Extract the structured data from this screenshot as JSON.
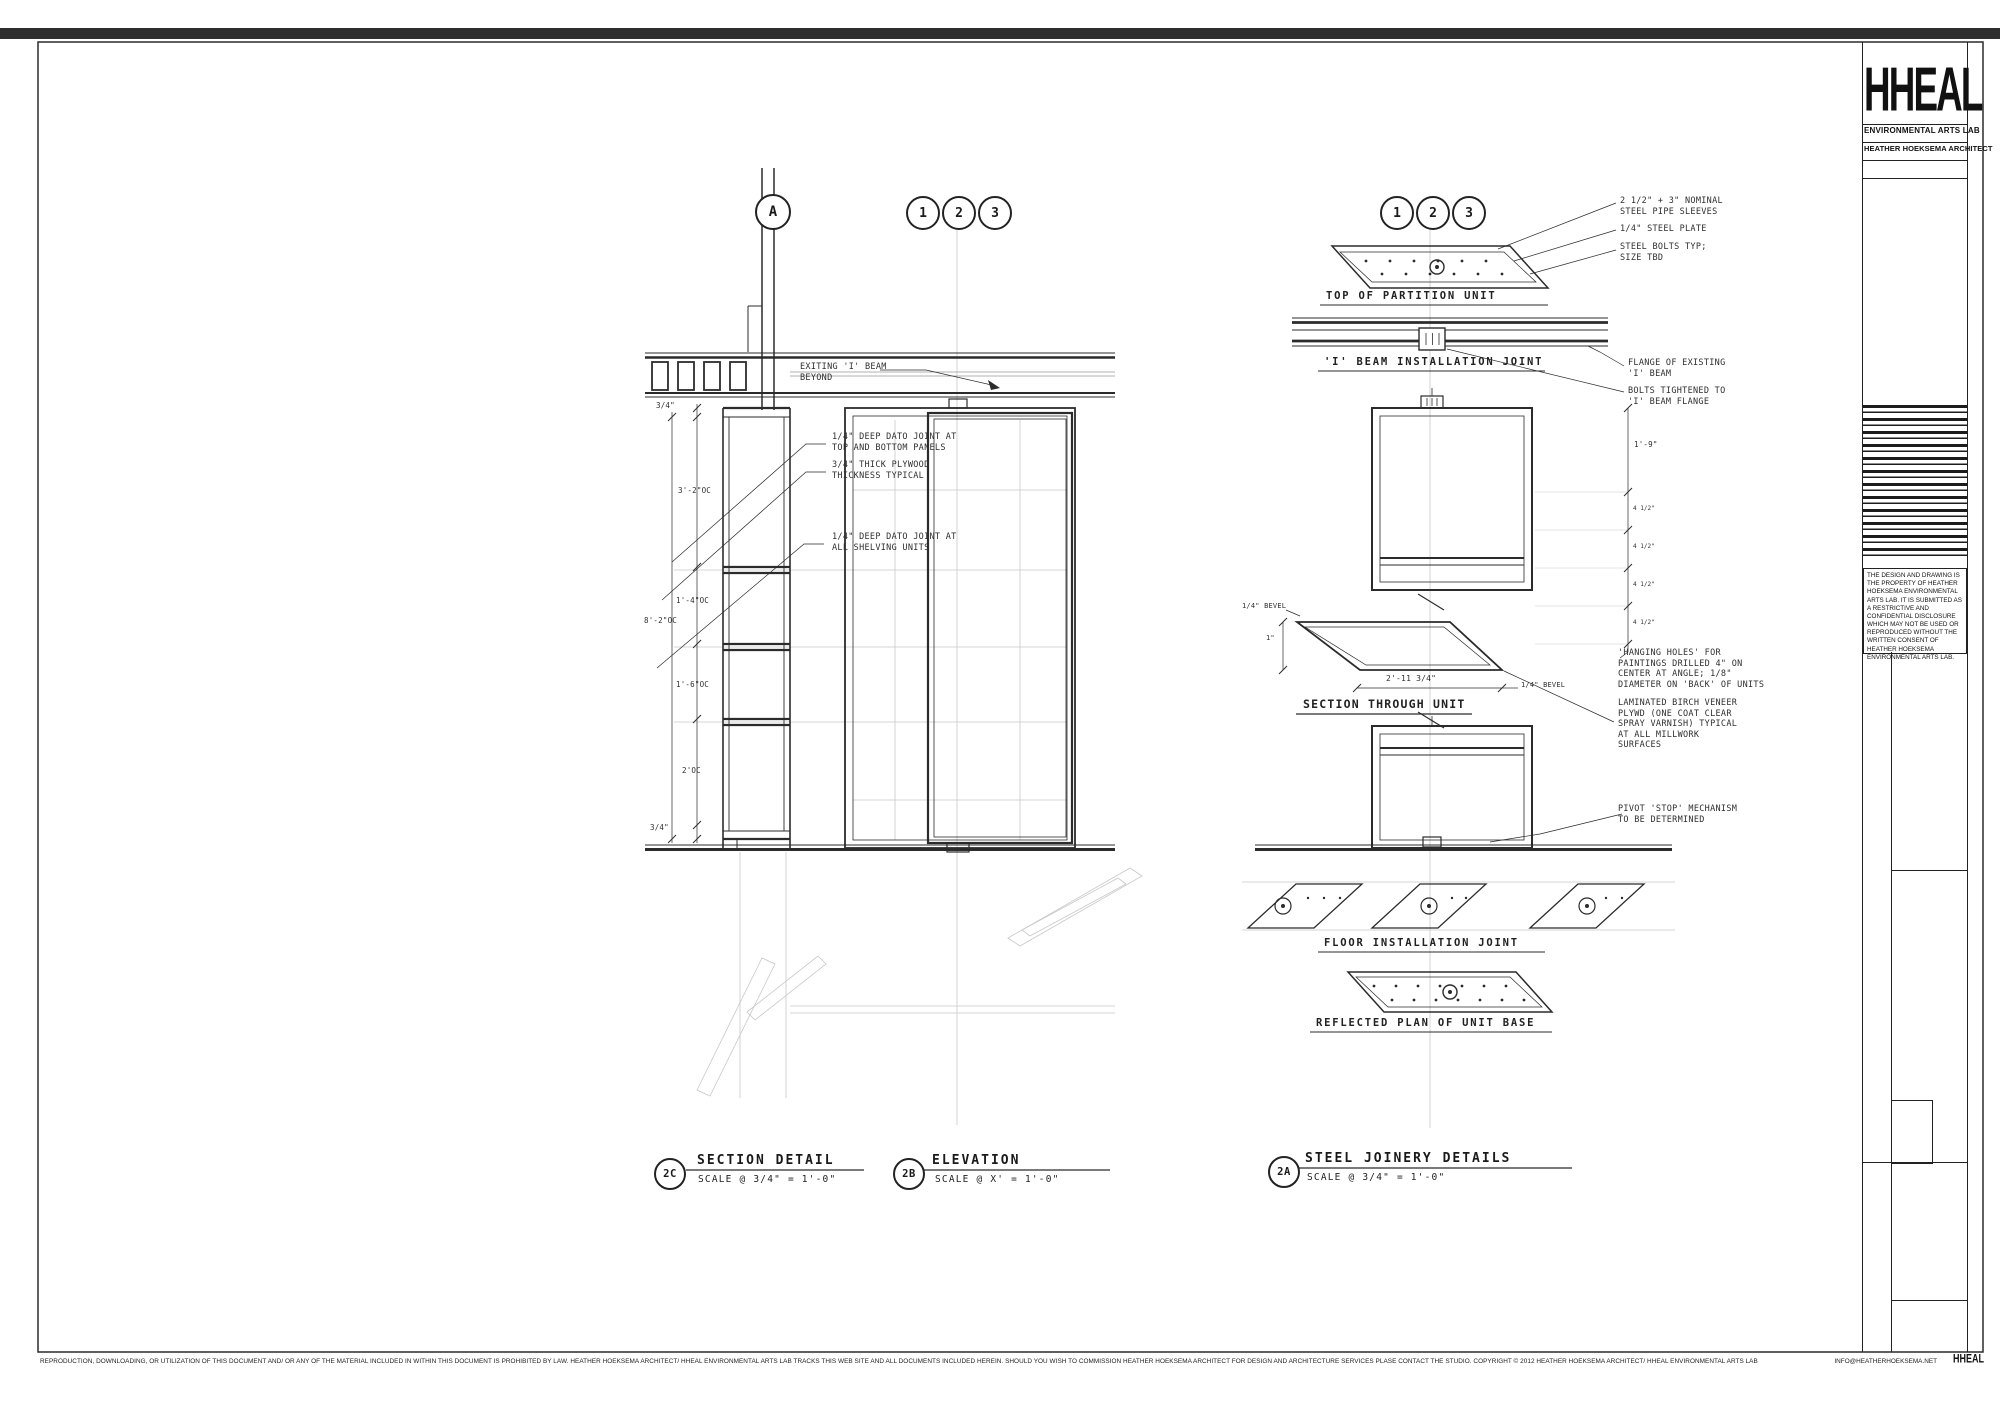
{
  "title_block": {
    "logo": "HHEAL",
    "org": "ENVIRONMENTAL ARTS LAB",
    "architect": "HEATHER HOEKSEMA ARCHITECT",
    "disclaimer": "THE DESIGN AND DRAWING IS THE PROPERTY OF HEATHER HOEKSEMA ENVIRONMENTAL ARTS LAB.  IT IS SUBMITTED AS A RESTRICTIVE AND CONFIDENTIAL DISCLOSURE WHICH MAY NOT BE USED OR REPRODUCED WITHOUT THE WRITTEN CONSENT OF HEATHER HOEKSEMA ENVIRONMENTAL ARTS LAB."
  },
  "footer": {
    "legal": "REPRODUCTION, DOWNLOADING, OR UTILIZATION OF THIS DOCUMENT AND/ OR ANY OF THE MATERIAL INCLUDED IN WITHIN THIS DOCUMENT IS PROHIBITED BY LAW.  HEATHER HOEKSEMA ARCHITECT/ HHEAL ENVIRONMENTAL ARTS LAB TRACKS THIS WEB SITE AND ALL DOCUMENTS INCLUDED HEREIN.  SHOULD YOU WISH TO COMMISSION HEATHER HOEKSEMA ARCHITECT FOR DESIGN AND ARCHITECTURE SERVICES PLASE CONTACT THE STUDIO.  COPYRIGHT © 2012 HEATHER HOEKSEMA ARCHITECT/ HHEAL ENVIRONMENTAL ARTS LAB",
    "email": "INFO@HEATHERHOEKSEMA.NET",
    "logo": "HHEAL"
  },
  "section_detail": {
    "ref_bubble": "A",
    "drawing_number": "2C",
    "title": "SECTION DETAIL",
    "scale": "SCALE @ 3/4\" = 1'-0\"",
    "annotations": {
      "exiting_beam": "EXITING 'I' BEAM\nBEYOND",
      "dato_top": "1/4\" DEEP DATO JOINT AT\nTOP AND BOTTOM PANELS",
      "plywood": "3/4\" THICK PLYWOOD\nTHICKNESS TYPICAL",
      "dato_shelving": "1/4\" DEEP DATO JOINT AT\nALL SHELVING UNITS"
    },
    "dimensions": {
      "top_panel": "3/4\"",
      "d1": "3'-2\"OC",
      "d2": "1'-4\"OC",
      "overall": "8'-2\"OC",
      "d3": "1'-6\"OC",
      "d4": "2'OC",
      "bottom_panel": "3/4\""
    }
  },
  "elevation": {
    "grid_bubbles": [
      "1",
      "2",
      "3"
    ],
    "drawing_number": "2B",
    "title": "ELEVATION",
    "scale": "SCALE @ X' = 1'-0\""
  },
  "steel_joinery": {
    "grid_bubbles": [
      "1",
      "2",
      "3"
    ],
    "drawing_number": "2A",
    "title": "STEEL JOINERY DETAILS",
    "scale": "SCALE @ 3/4\" = 1'-0\"",
    "sub_titles": {
      "top_of_partition": "TOP OF PARTITION UNIT",
      "ibeam_joint": "'I' BEAM INSTALLATION JOINT",
      "section_through": "SECTION THROUGH UNIT",
      "floor_joint": "FLOOR INSTALLATION JOINT",
      "reflected_plan": "REFLECTED PLAN OF UNIT BASE"
    },
    "callouts": {
      "pipe_sleeves": "2 1/2\" + 3\" NOMINAL\nSTEEL PIPE SLEEVES",
      "steel_plate": "1/4\" STEEL PLATE",
      "steel_bolts": "STEEL BOLTS TYP;\nSIZE TBD",
      "flange": "FLANGE OF EXISTING\n'I' BEAM",
      "bolts_tightened": "BOLTS TIGHTENED TO\n'I' BEAM FLANGE",
      "hanging_holes": "'HANGING HOLES' FOR\nPAINTINGS DRILLED 4\" ON\nCENTER AT ANGLE; 1/8\"\nDIAMETER ON 'BACK' OF UNITS",
      "laminated": "LAMINATED BIRCH VENEER\nPLYWD (ONE COAT CLEAR\nSPRAY VARNISH) TYPICAL\nAT ALL MILLWORK\nSURFACES",
      "pivot": "PIVOT 'STOP' MECHANISM\nTO BE DETERMINED"
    },
    "dimensions": {
      "height": "1'-9\"",
      "hole_spacing": "4 1/2\"",
      "bevel": "1/4\" BEVEL",
      "depth": "1\"",
      "width": "2'-11 3/4\""
    }
  }
}
